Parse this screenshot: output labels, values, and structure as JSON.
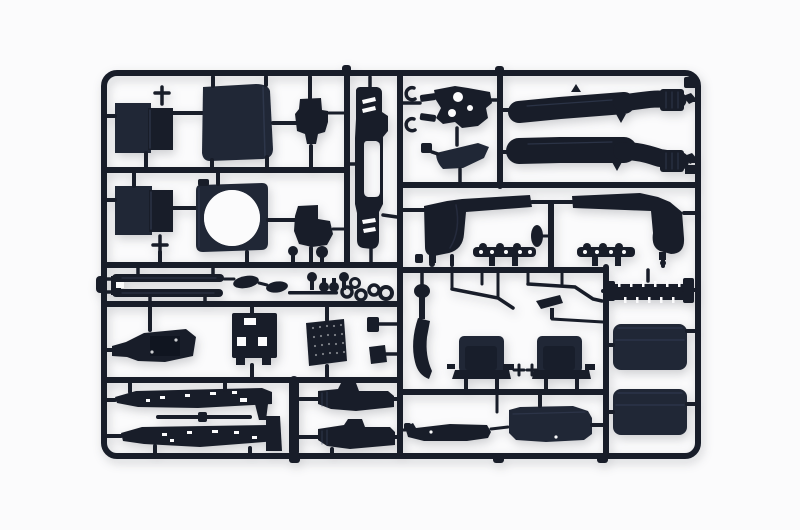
{
  "meta": {
    "type": "product-photograph",
    "subject": "model-kit-sprue",
    "description": "Photograph of a rectangular injection-molded sprue (parts tree) of glossy black styrene truck model parts on a plain white background",
    "material": "black styrene plastic"
  },
  "colors": {
    "background": "#fbfbfc",
    "plastic": "#181d29",
    "panel": "#202736",
    "highlight": "#3e4963",
    "shadow": "rgba(24,28,40,0.20)"
  },
  "sprue": {
    "frame_shape": "rounded rectangle with internal runner bars",
    "parts": [
      {
        "id": "radiator-core-upper",
        "label": "rectangular core panel with side tank"
      },
      {
        "id": "cab-rear-panel",
        "label": "large square cab panel"
      },
      {
        "id": "engine-mount-bracket",
        "label": "small stepped bracket"
      },
      {
        "id": "ladder-frame-upright",
        "label": "tall frame part with step cut-outs and oval opening"
      },
      {
        "id": "radiator-core-lower",
        "label": "rectangular core panel with side tank"
      },
      {
        "id": "fan-shroud-ring",
        "label": "square frame with large round opening"
      },
      {
        "id": "small-bracket",
        "label": "small wedge bracket"
      },
      {
        "id": "suspension-bracket",
        "label": "perforated suspension bracket"
      },
      {
        "id": "clamp-hooks",
        "label": "two small c-clamp hooks"
      },
      {
        "id": "sun-visor",
        "label": "curved visor panel"
      },
      {
        "id": "exhaust-pipe-upper",
        "label": "long exhaust pipe with bent tip"
      },
      {
        "id": "exhaust-pipe-lower",
        "label": "long exhaust pipe with bent tip"
      },
      {
        "id": "wheel-arch-left",
        "label": "wheel arch with horn extension"
      },
      {
        "id": "wheel-arch-right",
        "label": "wheel arch with horn extension, mirrored"
      },
      {
        "id": "hub-cover-oval",
        "label": "small oval cover"
      },
      {
        "id": "mudguard-bracket-strip-left",
        "label": "perforated bracket strip"
      },
      {
        "id": "mudguard-bracket-strip-right",
        "label": "perforated bracket strip"
      },
      {
        "id": "bumper-loop",
        "label": "double bumper bar loop"
      },
      {
        "id": "mirror-housing-large",
        "label": "oval mirror housing"
      },
      {
        "id": "mirror-housing-small",
        "label": "oval mirror housing, small"
      },
      {
        "id": "pin-set",
        "label": "cluster of small pins and plugs"
      },
      {
        "id": "ring-set",
        "label": "cluster of small rings"
      },
      {
        "id": "engine-block",
        "label": "engine block assembly"
      },
      {
        "id": "cab-floor-bracket",
        "label": "bracket with rectangular cut-outs"
      },
      {
        "id": "tread-plate",
        "label": "knurled step plate"
      },
      {
        "id": "side-bracket-pair",
        "label": "two small side brackets"
      },
      {
        "id": "chassis-rail-upper",
        "label": "long drilled chassis rail"
      },
      {
        "id": "front-axle-rod",
        "label": "thin axle rod"
      },
      {
        "id": "chassis-rail-lower",
        "label": "long drilled chassis rail"
      },
      {
        "id": "gearbox-half-upper",
        "label": "stepped gearbox half"
      },
      {
        "id": "gearbox-half-lower",
        "label": "stepped gearbox half"
      },
      {
        "id": "gear-lever",
        "label": "gear lever with knob and curved blade"
      },
      {
        "id": "wiper-arm-left",
        "label": "thin angled wiper arm"
      },
      {
        "id": "wiper-arm-right",
        "label": "thin angled wiper arm"
      },
      {
        "id": "mirror-arm",
        "label": "angled mirror arm"
      },
      {
        "id": "seat-left",
        "label": "cab seat with backrest"
      },
      {
        "id": "seat-right",
        "label": "cab seat with backrest"
      },
      {
        "id": "cab-step-panel",
        "label": "low step panel"
      },
      {
        "id": "rear-fender",
        "label": "rear fender panel"
      },
      {
        "id": "intercooler-ribbed-bar",
        "label": "ribbed intercooler bar"
      },
      {
        "id": "roof-panel",
        "label": "large rounded roof panel"
      },
      {
        "id": "rear-wall-panel",
        "label": "large rounded rear wall panel"
      }
    ]
  }
}
